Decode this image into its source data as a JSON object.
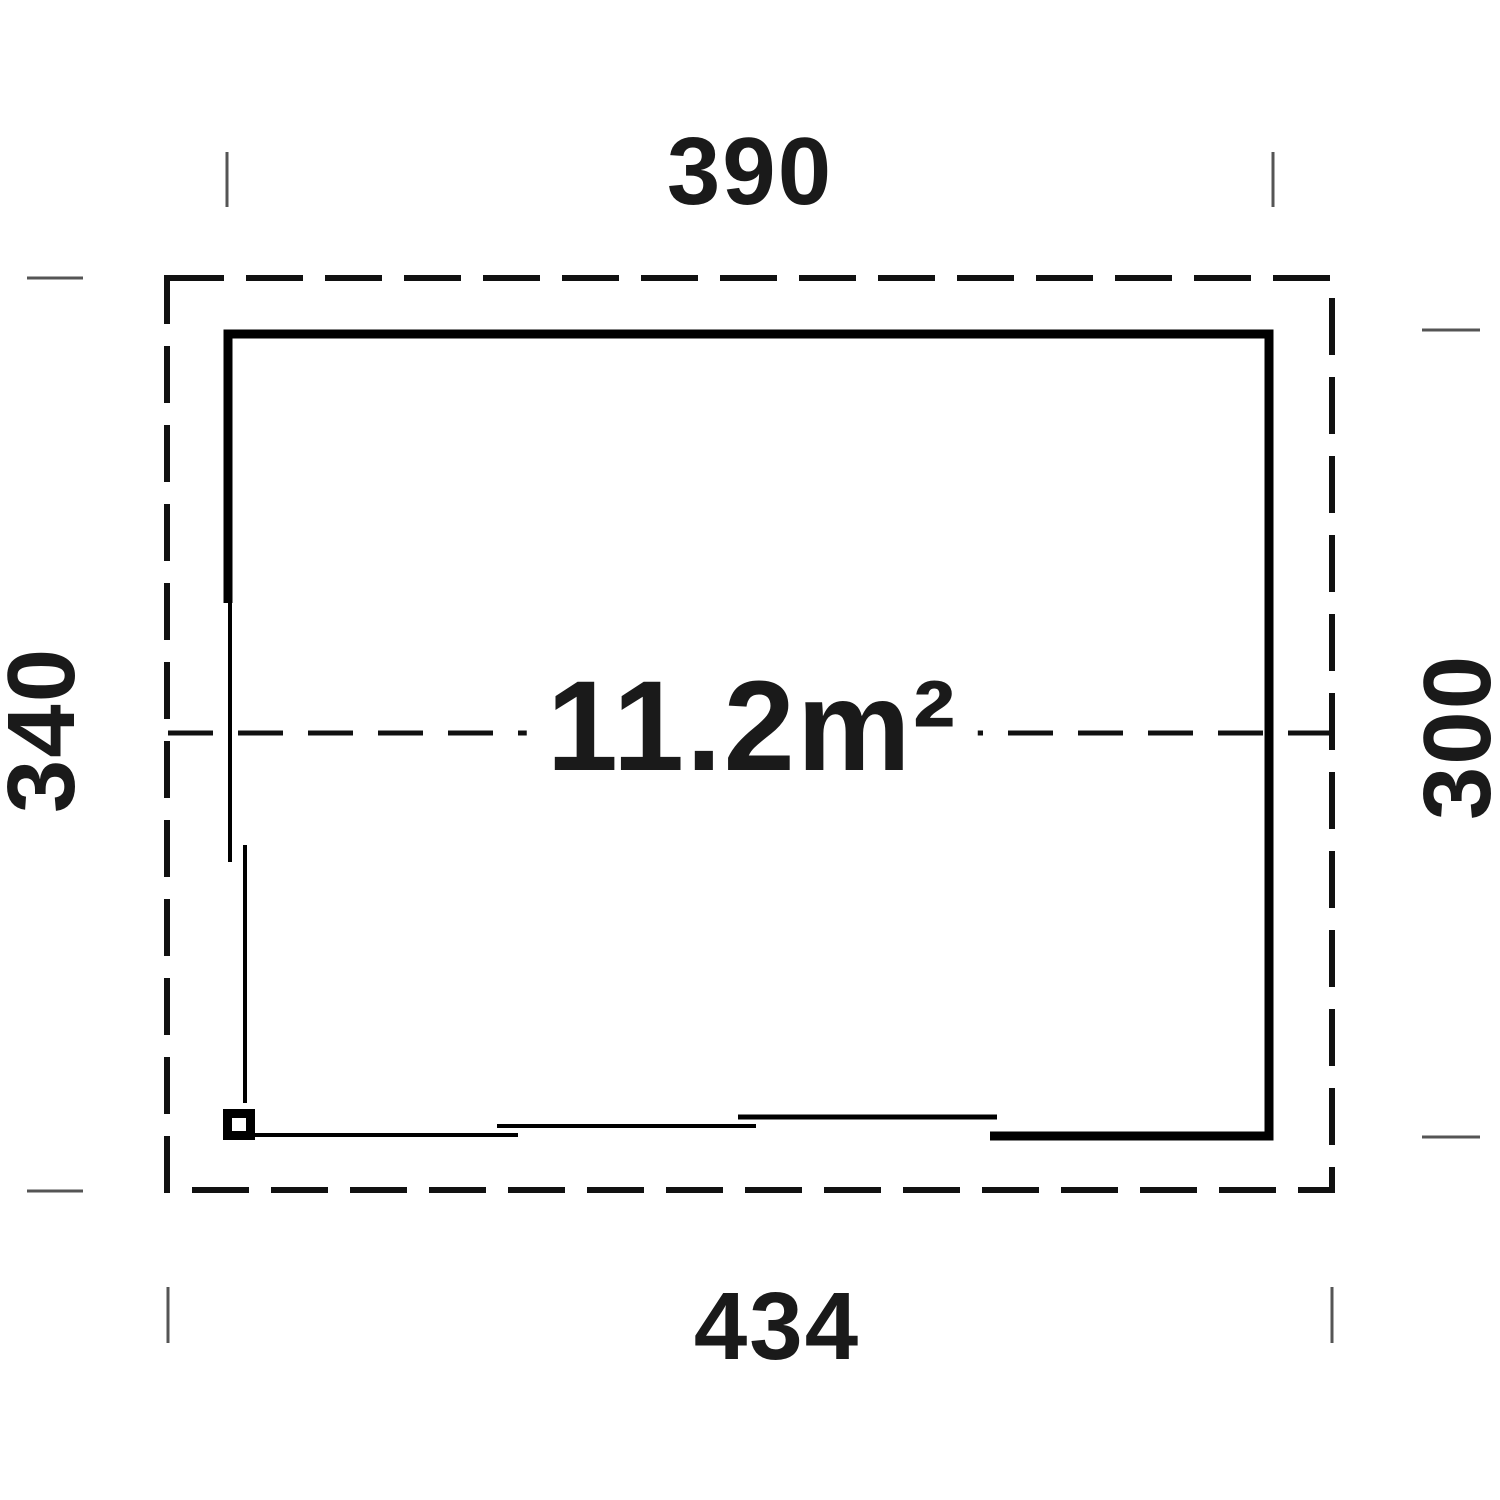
{
  "diagram": {
    "type": "floor-plan",
    "area_label": "11.2m²",
    "dimensions": {
      "top": "390",
      "left": "340",
      "right": "300",
      "bottom": "434"
    },
    "colors": {
      "wall_line": "#000000",
      "dashed_line": "#111111",
      "tick_line": "#555555",
      "text": "#1a1a1a",
      "background": "#ffffff"
    }
  }
}
